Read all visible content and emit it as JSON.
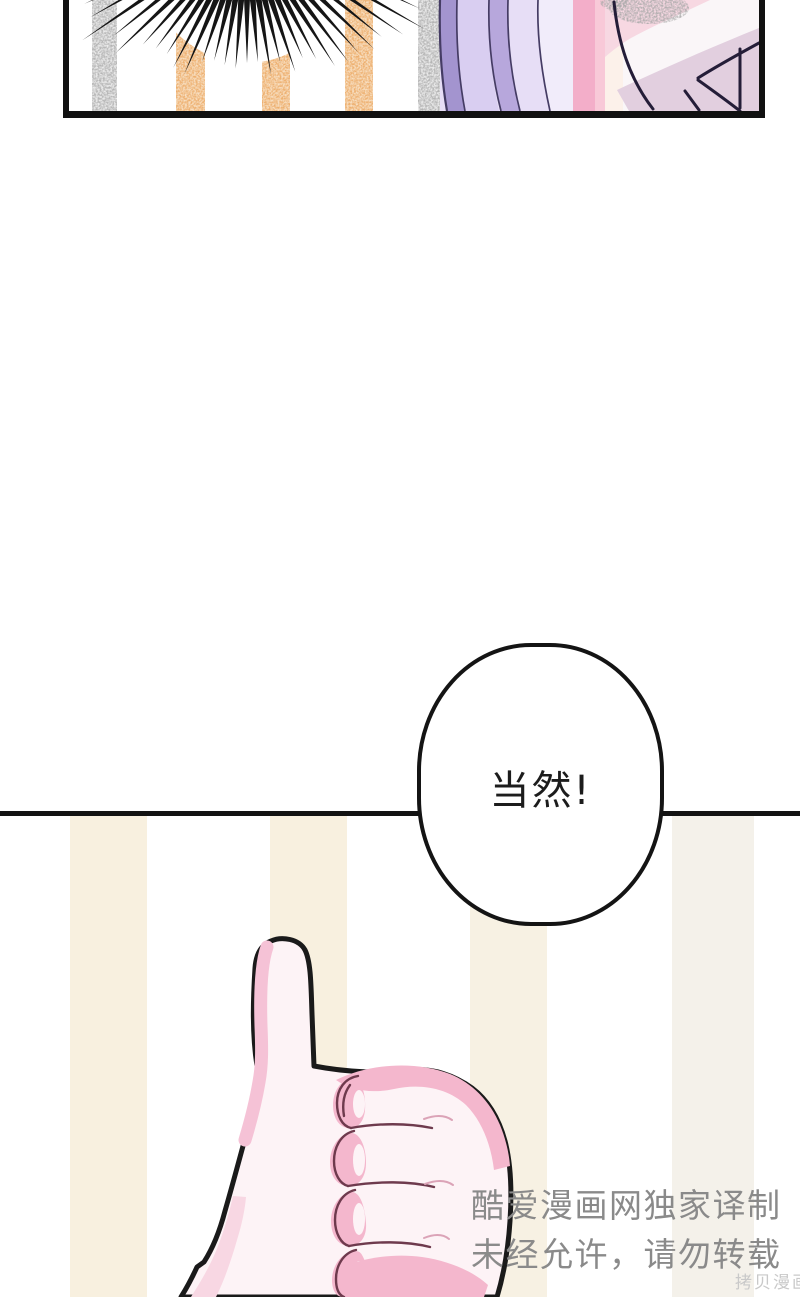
{
  "speech_bubble": {
    "text": "当然!"
  },
  "watermark": {
    "line1": "酷爱漫画网独家译制",
    "line2": "未经允许，请勿转载"
  },
  "corner_watermark": {
    "text": "拷贝漫画"
  },
  "palette": {
    "panel_border": "#111111",
    "stripe_gray_base": "#c9c9c9",
    "stripe_gray": "#b3b3b3",
    "stripe_orange_base": "#f2c792",
    "stripe_orange": "#edae6d",
    "stripe_cream": "#f7f1e3",
    "lash_black": "#151515",
    "hair_dark": "#a394cf",
    "hair_light": "#d9cef1",
    "hair_mid": "#b7a7dc",
    "hair_pale": "#e7def6",
    "hair_palest": "#f1ecfa",
    "hair_line": "#453c64",
    "pink_band": "#f3aec9",
    "pink_band_light": "#f8c9d8",
    "skin_pale": "#fcf1ea",
    "face_bg": "#faf6f8",
    "pink_top": "#f7d8e2",
    "mauve": "#e2cfdf",
    "stipple_gray": "#a8a8a8",
    "dark_line": "#241d38",
    "bubble_fill": "#ffffff",
    "bubble_stroke": "#141414",
    "hand_fill": "#fdf3f6",
    "hand_outline": "#1a1a1a",
    "hand_pink": "#f4b7cd",
    "hand_pink_soft": "#f5c2d6",
    "hand_pink_light": "#f8d7e3",
    "knuckle_line": "#6e3a4d",
    "crease_faint": "#dba3b7",
    "watermark_gray": "#8a8a8a",
    "corner_gray": "#c9c9c9"
  },
  "art": {
    "lash_count": 29
  }
}
